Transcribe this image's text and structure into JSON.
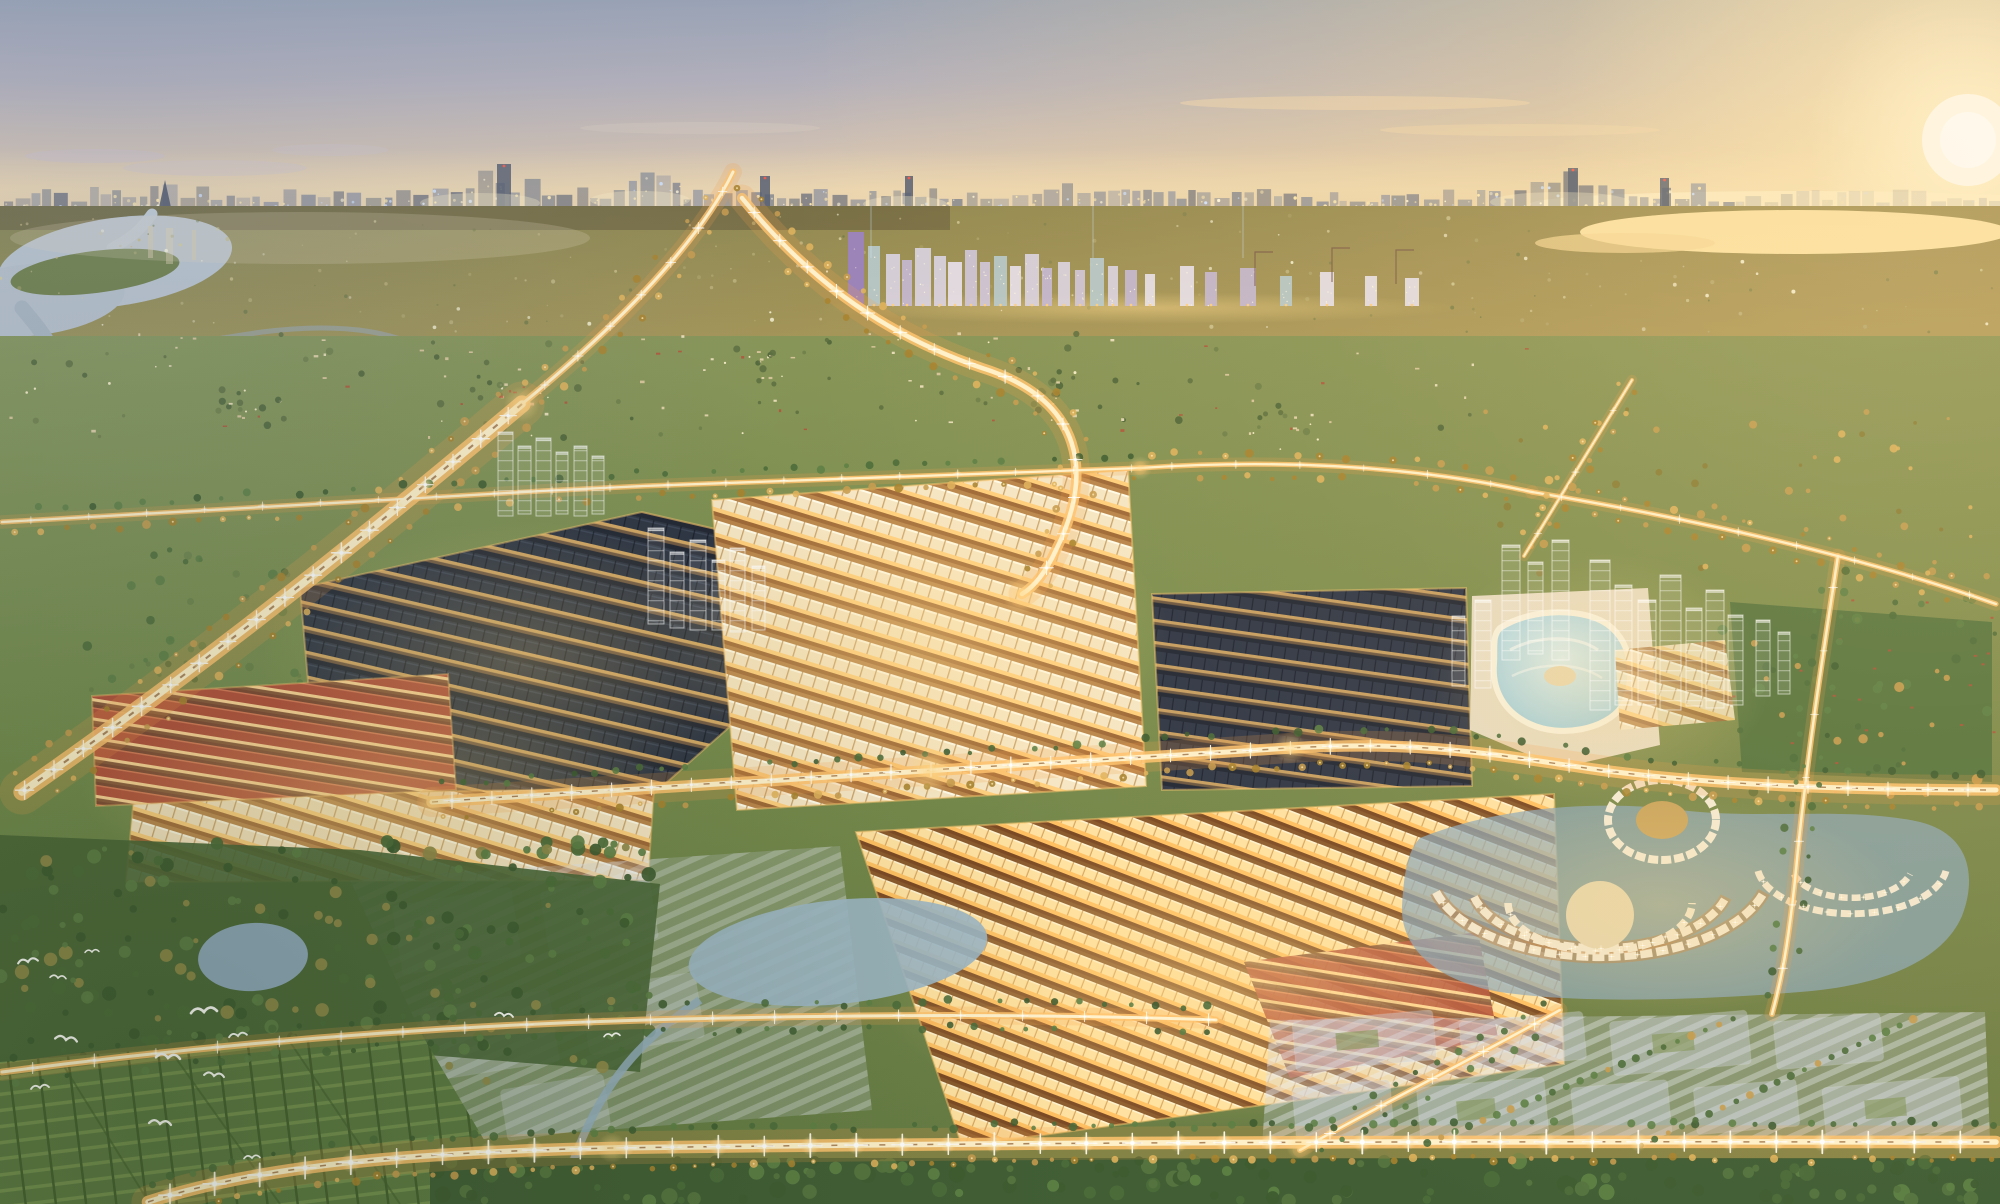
{
  "image_type": "aerial-cityscape-sunset-render",
  "visible_text": [],
  "palette": {
    "sky_top": "#9aa3b5",
    "sky_mid": "#c9bcb4",
    "sky_warm": "#eed7ae",
    "sun_core": "#fffaee",
    "sun_glow": "#ffe5a6",
    "horizon_haze": "#f2ddb2",
    "city_silhouette": "#6e7587",
    "city_silhouette_alt": "#7b8294",
    "city_silhouette_dark": "#5c6375",
    "city_light_warm": "#ffe9ae",
    "city_light_cool": "#cfe2ff",
    "river_water": "#c3ccd6",
    "lake_glare": "#ffe6a8",
    "field_olive": "#8b8a57",
    "grass_green": "#6d8a4c",
    "forest_green": "#4c6c3a",
    "forest_green_dark": "#3f5c31",
    "forest_green_lite": "#5d7f45",
    "tree_gold": "#c79c4f",
    "tree_gold_lite": "#e0b35c",
    "roof_dark": "#2c3340",
    "roof_red": "#b4513a",
    "facade_lit": "#f6e6c4",
    "street_gold": "#ffcf7d",
    "road_core": "#fff3d0",
    "road_mid": "#ffc36e",
    "road_glow": "#f5a04c",
    "median_warm": "#8a5a30",
    "lagoon_blue": "#9fd4de",
    "pond_blue": "#9cb6c4",
    "ghost_white": "#ffffff",
    "parcel_gray": "#cdd2de",
    "paddy_green": "#5d7a41",
    "bird_white": "#fbfbf6",
    "tower_lavender": "#d9d2e2",
    "tower_lavender2": "#cfc5da",
    "tower_pale": "#e6e0ec",
    "tower_mauve": "#c4b7d2",
    "tower_teal": "#b7c9cc",
    "tower_purple": "#9b82c2",
    "warehouse_red": "#c24b3c",
    "warehouse_blue": "#9fc0d6",
    "warehouse_white": "#e8ecf0",
    "deck_cream": "#ecdfc8"
  },
  "render_params": {
    "street_light_base_spacing_px": 40,
    "road_tree_spacing_px": 24,
    "skyline_segment_min_px": 7,
    "skyline_light_chance": 0.85,
    "far_field_speckles": 210,
    "village_speckles": 130,
    "village_cluster_count": 5,
    "village_cluster_items": 18,
    "forest_tree_count": 230,
    "forest_edge_tree_count": 40,
    "bottom_tree_count": 130,
    "northeast_tree_count": 70,
    "warehouse_count": 20,
    "ghost_tower_floor_px": 10,
    "bird_count": 13,
    "ghost_pad_rows": [
      1022,
      1088
    ]
  }
}
